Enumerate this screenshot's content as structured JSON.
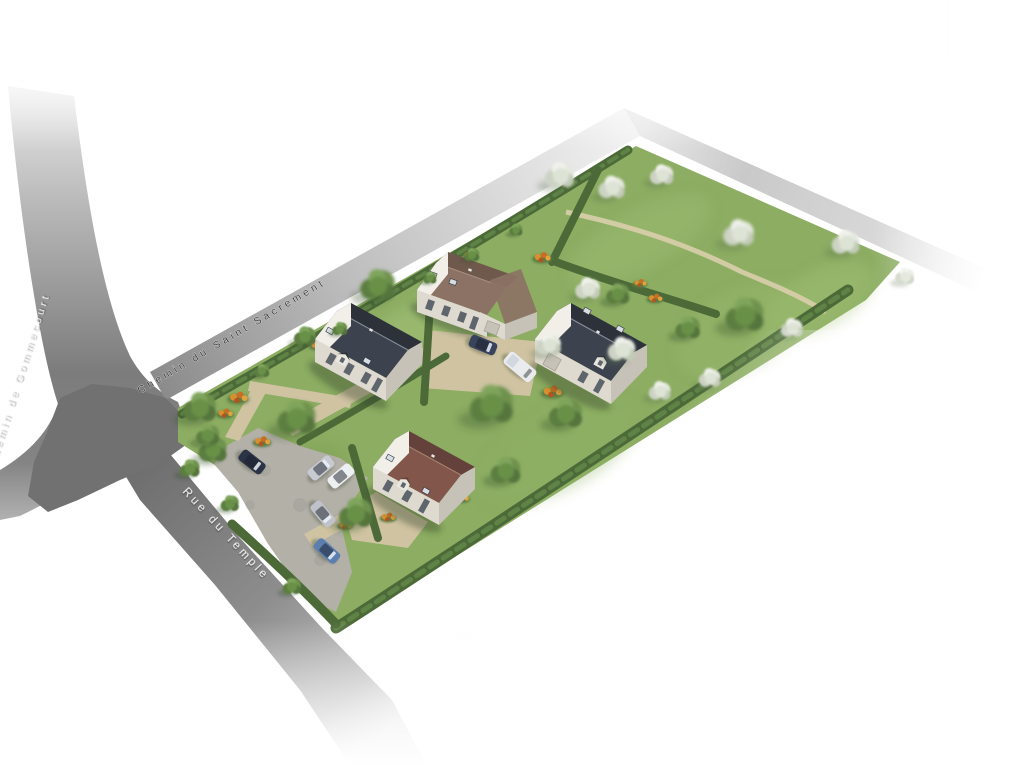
{
  "scene": {
    "description": "Aerial 3D rendering of a residential building plot with four detached houses, gardens, hedges, an orchard and a gravel parking court",
    "background": "#ffffff"
  },
  "streets": {
    "chemin_du_saint_sacrement": "Chemin du Saint Sacrement",
    "chemin_de_gommecourt": "Chemin de Gommecourt",
    "rue_du_temple": "Rue du Temple"
  },
  "site": {
    "house_count": 4,
    "houses": [
      {
        "position": "north",
        "roof_color": "taupe-brown",
        "wall_color": "off-white",
        "features": "garage annex, roof windows"
      },
      {
        "position": "west",
        "roof_color": "dark-slate",
        "wall_color": "off-white",
        "features": "dormer, roof windows"
      },
      {
        "position": "east",
        "roof_color": "dark-slate",
        "wall_color": "off-white",
        "features": "garage door, dormer"
      },
      {
        "position": "south",
        "roof_color": "red-brown",
        "wall_color": "off-white",
        "features": "dormer, roof windows"
      }
    ],
    "parked_cars": 7
  },
  "palette": {
    "grass": "#8cad62",
    "grass_light": "#a7c57c",
    "hedge": "#4c6a38",
    "hedge_hi": "#5f8346",
    "path": "#cfc3a2",
    "parking": "#b3b0a8",
    "road_dark": "#717171",
    "road_mid": "#a9a9a9",
    "wall_lit": "#f1efe8",
    "wall": "#dedacf",
    "wall_dk": "#c6c2b7",
    "slate_sw": "#3d434e",
    "slate_ne": "#2c313a",
    "brown_sw": "#82564a",
    "brown_ne": "#64413a",
    "taupe_sw": "#8c7265",
    "taupe_ne": "#6f584c",
    "window_dark": "#5f656d",
    "label_dark": "#3f3f3f",
    "label_light": "#f4f4f4"
  }
}
